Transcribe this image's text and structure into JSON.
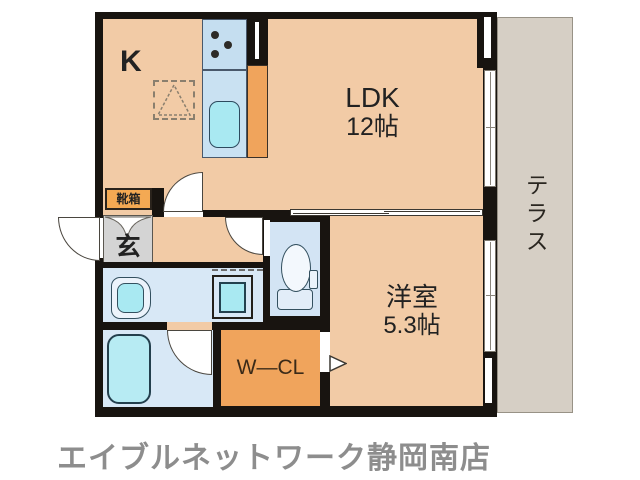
{
  "floorplan": {
    "labels": {
      "kitchen": "K",
      "ldk": "LDK",
      "ldk_size": "12帖",
      "western_room": "洋室",
      "western_room_size": "5.3帖",
      "terrace": "テラス",
      "entrance": "玄",
      "shoe_box": "靴箱",
      "walk_in_closet": "W—CL"
    },
    "colors": {
      "wall": "#181410",
      "room": "#f2cba6",
      "terrace": "#d6cfc5",
      "water": "#d8e8f6",
      "water2": "#d3e4f4",
      "fixture": "#a9e9f2",
      "tub": "#b7ebf3",
      "orange": "#f0a45c",
      "entrance_gray": "#d4d4d4",
      "footer_text": "#8d8d8d",
      "label": "#222222"
    }
  },
  "footer": {
    "store_name": "エイブルネットワーク静岡南店"
  }
}
